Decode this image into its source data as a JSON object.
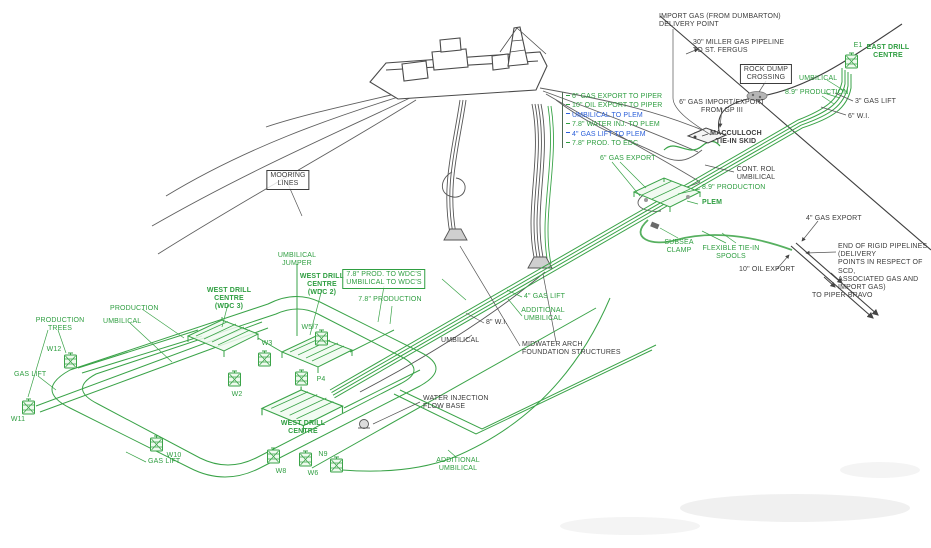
{
  "title": "",
  "colors": {
    "green": "#2f9e41",
    "dark": "#3c3c3c",
    "blue": "#2b5fd9",
    "line_green": "#3aa348",
    "line_dark": "#4a4a4a",
    "background": "#ffffff"
  },
  "riser_legend": {
    "items": [
      {
        "text": "6\" GAS EXPORT TO PIPER",
        "color": "green"
      },
      {
        "text": "10\" OIL EXPORT TO PIPER",
        "color": "green"
      },
      {
        "text": "UMBILICAL TO PLEM",
        "color": "blue"
      },
      {
        "text": "7.8\" WATER INJ. TO PLEM",
        "color": "green"
      },
      {
        "text": "4\" GAS LIFT TO PLEM",
        "color": "blue"
      },
      {
        "text": "7.8\" PROD. TO EDC",
        "color": "green"
      }
    ]
  },
  "labels": [
    {
      "id": "import-gas-delivery",
      "text": "IMPORT GAS (FROM DUMBARTON)\nDELIVERY POINT",
      "x": 659,
      "y": 13,
      "anchor": "left",
      "color": "dark"
    },
    {
      "id": "miller-pipeline",
      "text": "30\" MILLER GAS PIPELINE\nTO ST. FERGUS",
      "x": 693,
      "y": 39,
      "anchor": "left",
      "color": "dark"
    },
    {
      "id": "rock-dump-crossing",
      "text": "ROCK DUMP\nCROSSING",
      "x": 766,
      "y": 64,
      "anchor": "center",
      "color": "dark",
      "boxed": true
    },
    {
      "id": "gas-import-export-gp3",
      "text": "6\" GAS IMPORT/EXPORT\nFROM GP III",
      "x": 722,
      "y": 99,
      "anchor": "center",
      "color": "dark"
    },
    {
      "id": "macculloch-tie-in-skid",
      "text": "MACCULLOCH\nTIE-IN SKID",
      "x": 736,
      "y": 130,
      "anchor": "center",
      "color": "dark",
      "bold": true
    },
    {
      "id": "east-drill-centre",
      "text": "EAST DRILL\nCENTRE",
      "x": 888,
      "y": 44,
      "anchor": "center",
      "color": "green",
      "bold": true
    },
    {
      "id": "well-e1",
      "text": "E1",
      "x": 858,
      "y": 42,
      "anchor": "center",
      "color": "green"
    },
    {
      "id": "umbilical-ne",
      "text": "UMBILICAL",
      "x": 799,
      "y": 75,
      "anchor": "left",
      "color": "green"
    },
    {
      "id": "production-89-ne",
      "text": "8.9\" PRODUCTION",
      "x": 785,
      "y": 89,
      "anchor": "left",
      "color": "green"
    },
    {
      "id": "gas-lift-3in",
      "text": "3\" GAS LIFT",
      "x": 855,
      "y": 98,
      "anchor": "left",
      "color": "dark"
    },
    {
      "id": "wi-6in",
      "text": "6\" W.I.",
      "x": 848,
      "y": 113,
      "anchor": "left",
      "color": "dark"
    },
    {
      "id": "gas-export-6in",
      "text": "6\" GAS EXPORT",
      "x": 600,
      "y": 155,
      "anchor": "left",
      "color": "green"
    },
    {
      "id": "control-umbilical",
      "text": "CONT. ROL\nUMBILICAL",
      "x": 756,
      "y": 166,
      "anchor": "center",
      "color": "dark"
    },
    {
      "id": "production-89-mid",
      "text": "8.9\" PRODUCTION",
      "x": 702,
      "y": 184,
      "anchor": "left",
      "color": "green"
    },
    {
      "id": "plem",
      "text": "PLEM",
      "x": 702,
      "y": 199,
      "anchor": "left",
      "color": "green",
      "bold": true
    },
    {
      "id": "subsea-clamp",
      "text": "SUBSEA\nCLAMP",
      "x": 679,
      "y": 239,
      "anchor": "center",
      "color": "green"
    },
    {
      "id": "flexible-tie-in-spools",
      "text": "FLEXIBLE TIE-IN\nSPOOLS",
      "x": 731,
      "y": 245,
      "anchor": "center",
      "color": "green"
    },
    {
      "id": "oil-export-10in",
      "text": "10\" OIL EXPORT",
      "x": 739,
      "y": 266,
      "anchor": "left",
      "color": "dark"
    },
    {
      "id": "gas-export-4in",
      "text": "4\" GAS EXPORT",
      "x": 806,
      "y": 215,
      "anchor": "left",
      "color": "dark"
    },
    {
      "id": "end-of-rigid-pipelines",
      "text": "END OF RIGID PIPELINES (DELIVERY\nPOINTS IN RESPECT OF SCD,\nASSOCIATED GAS AND IMPORT GAS)",
      "x": 838,
      "y": 243,
      "anchor": "left",
      "color": "dark"
    },
    {
      "id": "to-piper-bravo",
      "text": "TO PIPER BRAVO",
      "x": 812,
      "y": 292,
      "anchor": "left",
      "color": "dark"
    },
    {
      "id": "mooring-lines",
      "text": "MOORING\nLINES",
      "x": 288,
      "y": 170,
      "anchor": "center",
      "color": "dark",
      "boxed": true
    },
    {
      "id": "umbilical-jumper",
      "text": "UMBILICAL\nJUMPER",
      "x": 297,
      "y": 252,
      "anchor": "center",
      "color": "green"
    },
    {
      "id": "west-drill-centre-wdc3",
      "text": "WEST DRILL\nCENTRE\n(WDC 3)",
      "x": 229,
      "y": 287,
      "anchor": "center",
      "color": "green",
      "bold": true
    },
    {
      "id": "west-drill-centre-wdc2",
      "text": "WEST DRILL\nCENTRE\n(WDC 2)",
      "x": 322,
      "y": 273,
      "anchor": "center",
      "color": "green",
      "bold": true
    },
    {
      "id": "west-drill-centre-south",
      "text": "WEST DRILL\nCENTRE",
      "x": 303,
      "y": 420,
      "anchor": "center",
      "color": "green",
      "bold": true
    },
    {
      "id": "prod-umbilical-to-wdcs",
      "text": "7.8\" PROD. TO WDC'S\nUMBILICAL TO WDC'S",
      "x": 384,
      "y": 269,
      "anchor": "center",
      "color": "green",
      "boxed": true
    },
    {
      "id": "production-78",
      "text": "7.8\" PRODUCTION",
      "x": 390,
      "y": 296,
      "anchor": "center",
      "color": "green"
    },
    {
      "id": "production-nw",
      "text": "PRODUCTION",
      "x": 110,
      "y": 305,
      "anchor": "left",
      "color": "green"
    },
    {
      "id": "production-trees",
      "text": "PRODUCTION\nTREES",
      "x": 60,
      "y": 317,
      "anchor": "center",
      "color": "green"
    },
    {
      "id": "umbilical-nw",
      "text": "UMBILICAL",
      "x": 103,
      "y": 318,
      "anchor": "left",
      "color": "green"
    },
    {
      "id": "gas-lift-w",
      "text": "GAS LIFT",
      "x": 14,
      "y": 371,
      "anchor": "left",
      "color": "green"
    },
    {
      "id": "gas-lift-s",
      "text": "GAS LIFT",
      "x": 148,
      "y": 458,
      "anchor": "left",
      "color": "green"
    },
    {
      "id": "wi-8in",
      "text": "8\" W.I.",
      "x": 486,
      "y": 319,
      "anchor": "left",
      "color": "dark"
    },
    {
      "id": "umbilical-mid",
      "text": "UMBILICAL",
      "x": 441,
      "y": 337,
      "anchor": "left",
      "color": "dark"
    },
    {
      "id": "gas-lift-4in",
      "text": "4\" GAS LIFT",
      "x": 524,
      "y": 293,
      "anchor": "left",
      "color": "green"
    },
    {
      "id": "additional-umbilical-mid",
      "text": "ADDITIONAL\nUMBILICAL",
      "x": 543,
      "y": 307,
      "anchor": "center",
      "color": "green"
    },
    {
      "id": "midwater-arch",
      "text": "MIDWATER ARCH\nFOUNDATION STRUCTURES",
      "x": 522,
      "y": 341,
      "anchor": "left",
      "color": "dark"
    },
    {
      "id": "water-injection-flow-base",
      "text": "WATER INJECTION\nFLOW BASE",
      "x": 423,
      "y": 395,
      "anchor": "left",
      "color": "dark"
    },
    {
      "id": "additional-umbilical-s",
      "text": "ADDITIONAL\nUMBILICAL",
      "x": 458,
      "y": 457,
      "anchor": "center",
      "color": "green"
    },
    {
      "id": "well-w12",
      "text": "W12",
      "x": 54,
      "y": 346,
      "anchor": "center",
      "color": "green"
    },
    {
      "id": "well-w11",
      "text": "W11",
      "x": 18,
      "y": 416,
      "anchor": "center",
      "color": "green"
    },
    {
      "id": "well-w10",
      "text": "W10",
      "x": 174,
      "y": 452,
      "anchor": "center",
      "color": "green"
    },
    {
      "id": "well-w8",
      "text": "W8",
      "x": 281,
      "y": 468,
      "anchor": "center",
      "color": "green"
    },
    {
      "id": "well-w6",
      "text": "W6",
      "x": 313,
      "y": 470,
      "anchor": "center",
      "color": "green"
    },
    {
      "id": "well-n9",
      "text": "N9",
      "x": 323,
      "y": 451,
      "anchor": "center",
      "color": "green"
    },
    {
      "id": "well-w2",
      "text": "W2",
      "x": 237,
      "y": 391,
      "anchor": "center",
      "color": "green"
    },
    {
      "id": "well-w3",
      "text": "W3",
      "x": 267,
      "y": 340,
      "anchor": "center",
      "color": "green"
    },
    {
      "id": "well-w5-7",
      "text": "W5/7",
      "x": 310,
      "y": 324,
      "anchor": "center",
      "color": "green"
    },
    {
      "id": "well-p4",
      "text": "P4",
      "x": 321,
      "y": 376,
      "anchor": "center",
      "color": "green"
    }
  ],
  "trees": [
    {
      "id": "w12",
      "x": 64,
      "y": 353
    },
    {
      "id": "w11",
      "x": 22,
      "y": 399
    },
    {
      "id": "w10",
      "x": 150,
      "y": 436
    },
    {
      "id": "w8",
      "x": 267,
      "y": 448
    },
    {
      "id": "w6",
      "x": 299,
      "y": 451
    },
    {
      "id": "n9",
      "x": 330,
      "y": 457
    },
    {
      "id": "w2",
      "x": 228,
      "y": 371
    },
    {
      "id": "w3",
      "x": 258,
      "y": 351
    },
    {
      "id": "w5-7",
      "x": 315,
      "y": 330
    },
    {
      "id": "p4",
      "x": 295,
      "y": 370
    },
    {
      "id": "e1",
      "x": 845,
      "y": 53
    }
  ]
}
